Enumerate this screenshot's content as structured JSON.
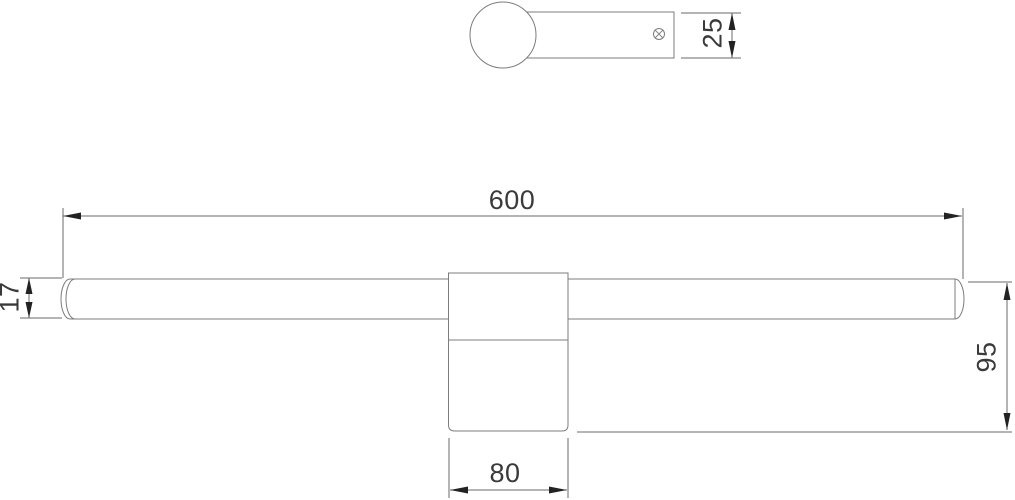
{
  "drawing": {
    "kind": "technical-dimension-drawing",
    "colors": {
      "background": "#ffffff",
      "outline": "#7d7d7d",
      "dimension_line": "#6a6a6a",
      "dimension_text": "#3a3a3a",
      "arrowhead": "#222222"
    },
    "dimensions": {
      "overall_width": "600",
      "bar_diameter": "17",
      "overall_height": "95",
      "mount_width": "80",
      "depth": "25"
    },
    "icons": {
      "screw": "screw-cross-icon"
    }
  }
}
